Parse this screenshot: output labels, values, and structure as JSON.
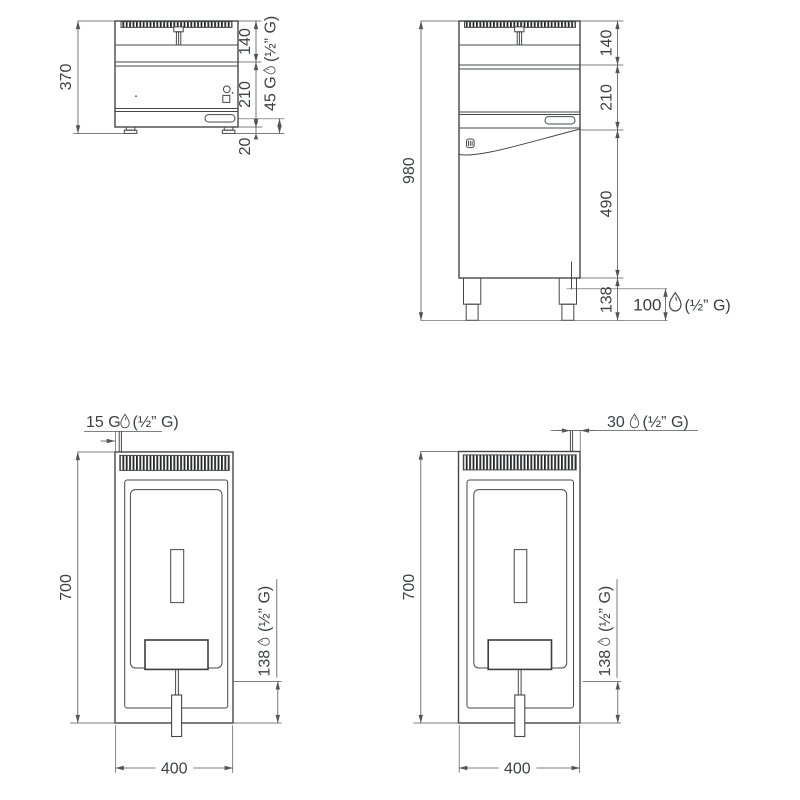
{
  "views": {
    "front_countertop": {
      "overall_height": "370",
      "sections": [
        "140",
        "210"
      ],
      "feet_height": "20",
      "gas_label": "45 G",
      "gas_thread": "(½” G)"
    },
    "front_floor": {
      "overall_height": "980",
      "sections": [
        "140",
        "210",
        "490",
        "138"
      ],
      "gas_height": "100",
      "gas_thread": "(½” G)"
    },
    "top_countertop": {
      "depth": "700",
      "width": "400",
      "gas_offset": "15 G",
      "gas_thread": "(½” G)",
      "rear_offset": "138",
      "rear_thread": "(½” G)"
    },
    "top_floor": {
      "depth": "700",
      "width": "400",
      "gas_offset": "30",
      "gas_thread": "(½” G)",
      "rear_offset": "138",
      "rear_thread": "(½” G)"
    }
  },
  "colors": {
    "line": "#46474b",
    "dim_line": "#53555a",
    "text": "#3c3f44",
    "grille": "#27282b"
  }
}
